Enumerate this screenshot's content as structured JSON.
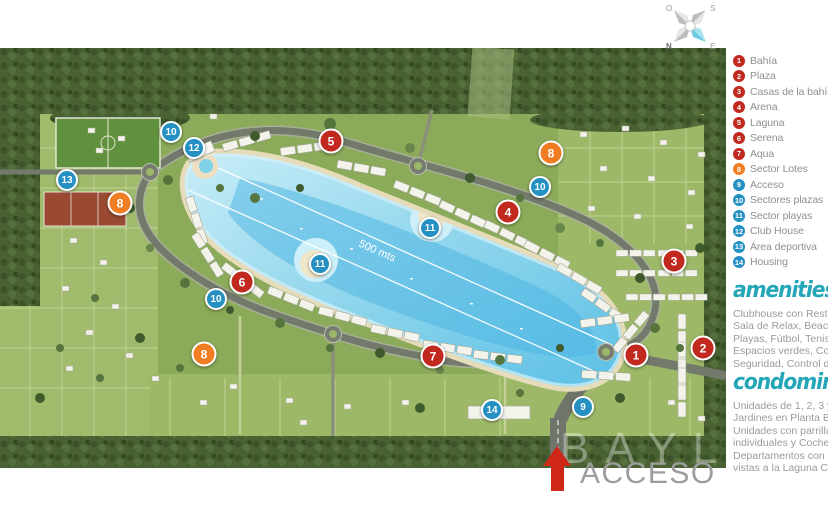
{
  "compass": {
    "o": "O",
    "s": "S",
    "n": "N",
    "e": "E"
  },
  "legend": {
    "items": [
      {
        "num": "1",
        "label": "Bahía",
        "color": "red"
      },
      {
        "num": "2",
        "label": "Plaza",
        "color": "red"
      },
      {
        "num": "3",
        "label": "Casas de la bahía",
        "color": "red"
      },
      {
        "num": "4",
        "label": "Arena",
        "color": "red"
      },
      {
        "num": "5",
        "label": "Laguna",
        "color": "red"
      },
      {
        "num": "6",
        "label": "Serena",
        "color": "red"
      },
      {
        "num": "7",
        "label": "Aqua",
        "color": "red"
      },
      {
        "num": "8",
        "label": "Sector Lotes",
        "color": "orange"
      },
      {
        "num": "9",
        "label": "Acceso",
        "color": "blue"
      },
      {
        "num": "10",
        "label": "Sectores plazas",
        "color": "blue"
      },
      {
        "num": "11",
        "label": "Sector playas",
        "color": "blue"
      },
      {
        "num": "12",
        "label": "Club House",
        "color": "blue"
      },
      {
        "num": "13",
        "label": "Área deportiva",
        "color": "blue"
      },
      {
        "num": "14",
        "label": "Housing",
        "color": "blue"
      }
    ]
  },
  "amenities": {
    "title": "amenities",
    "lines": [
      "Clubhouse con Restaurant,",
      "Sala de Relax, Beach Bar,",
      "Playas, Fútbol, Tenis, Voley,",
      "Espacios verdes, Cocheras,",
      "Seguridad, Control de Acceso."
    ]
  },
  "condominios": {
    "title": "condominios",
    "lines": [
      "Unidades de 1, 2, 3 y 4 ambientes.",
      "Jardines en Planta Baja.",
      "Unidades con parrillas",
      "individuales y Cocheras.",
      "Departamentos con increíbles",
      "vistas a la Laguna Central."
    ]
  },
  "map": {
    "measure_label": "500 mts",
    "acceso_label": "ACCESO",
    "watermark": "BAYL",
    "markers": [
      {
        "num": "10",
        "color": "blue",
        "x": 171,
        "y": 132
      },
      {
        "num": "12",
        "color": "blue",
        "x": 194,
        "y": 148
      },
      {
        "num": "5",
        "color": "red",
        "x": 331,
        "y": 141
      },
      {
        "num": "8",
        "color": "orange",
        "x": 551,
        "y": 153
      },
      {
        "num": "13",
        "color": "blue",
        "x": 67,
        "y": 180
      },
      {
        "num": "10",
        "color": "blue",
        "x": 540,
        "y": 187
      },
      {
        "num": "8",
        "color": "orange",
        "x": 120,
        "y": 203
      },
      {
        "num": "4",
        "color": "red",
        "x": 508,
        "y": 212
      },
      {
        "num": "11",
        "color": "blue",
        "x": 430,
        "y": 228
      },
      {
        "num": "3",
        "color": "red",
        "x": 674,
        "y": 261
      },
      {
        "num": "11",
        "color": "blue",
        "x": 320,
        "y": 264
      },
      {
        "num": "6",
        "color": "red",
        "x": 242,
        "y": 282
      },
      {
        "num": "10",
        "color": "blue",
        "x": 216,
        "y": 299
      },
      {
        "num": "2",
        "color": "red",
        "x": 703,
        "y": 348
      },
      {
        "num": "8",
        "color": "orange",
        "x": 204,
        "y": 354
      },
      {
        "num": "1",
        "color": "red",
        "x": 636,
        "y": 355
      },
      {
        "num": "7",
        "color": "red",
        "x": 433,
        "y": 356
      },
      {
        "num": "9",
        "color": "blue",
        "x": 583,
        "y": 407
      },
      {
        "num": "14",
        "color": "blue",
        "x": 492,
        "y": 410
      }
    ]
  },
  "colors": {
    "marker_red": "#c1281e",
    "marker_orange": "#f07d23",
    "marker_blue": "#2590c2",
    "accent_teal": "#23a6b7",
    "arrow_red": "#ce2617",
    "text_gray": "#9b9b9b"
  }
}
